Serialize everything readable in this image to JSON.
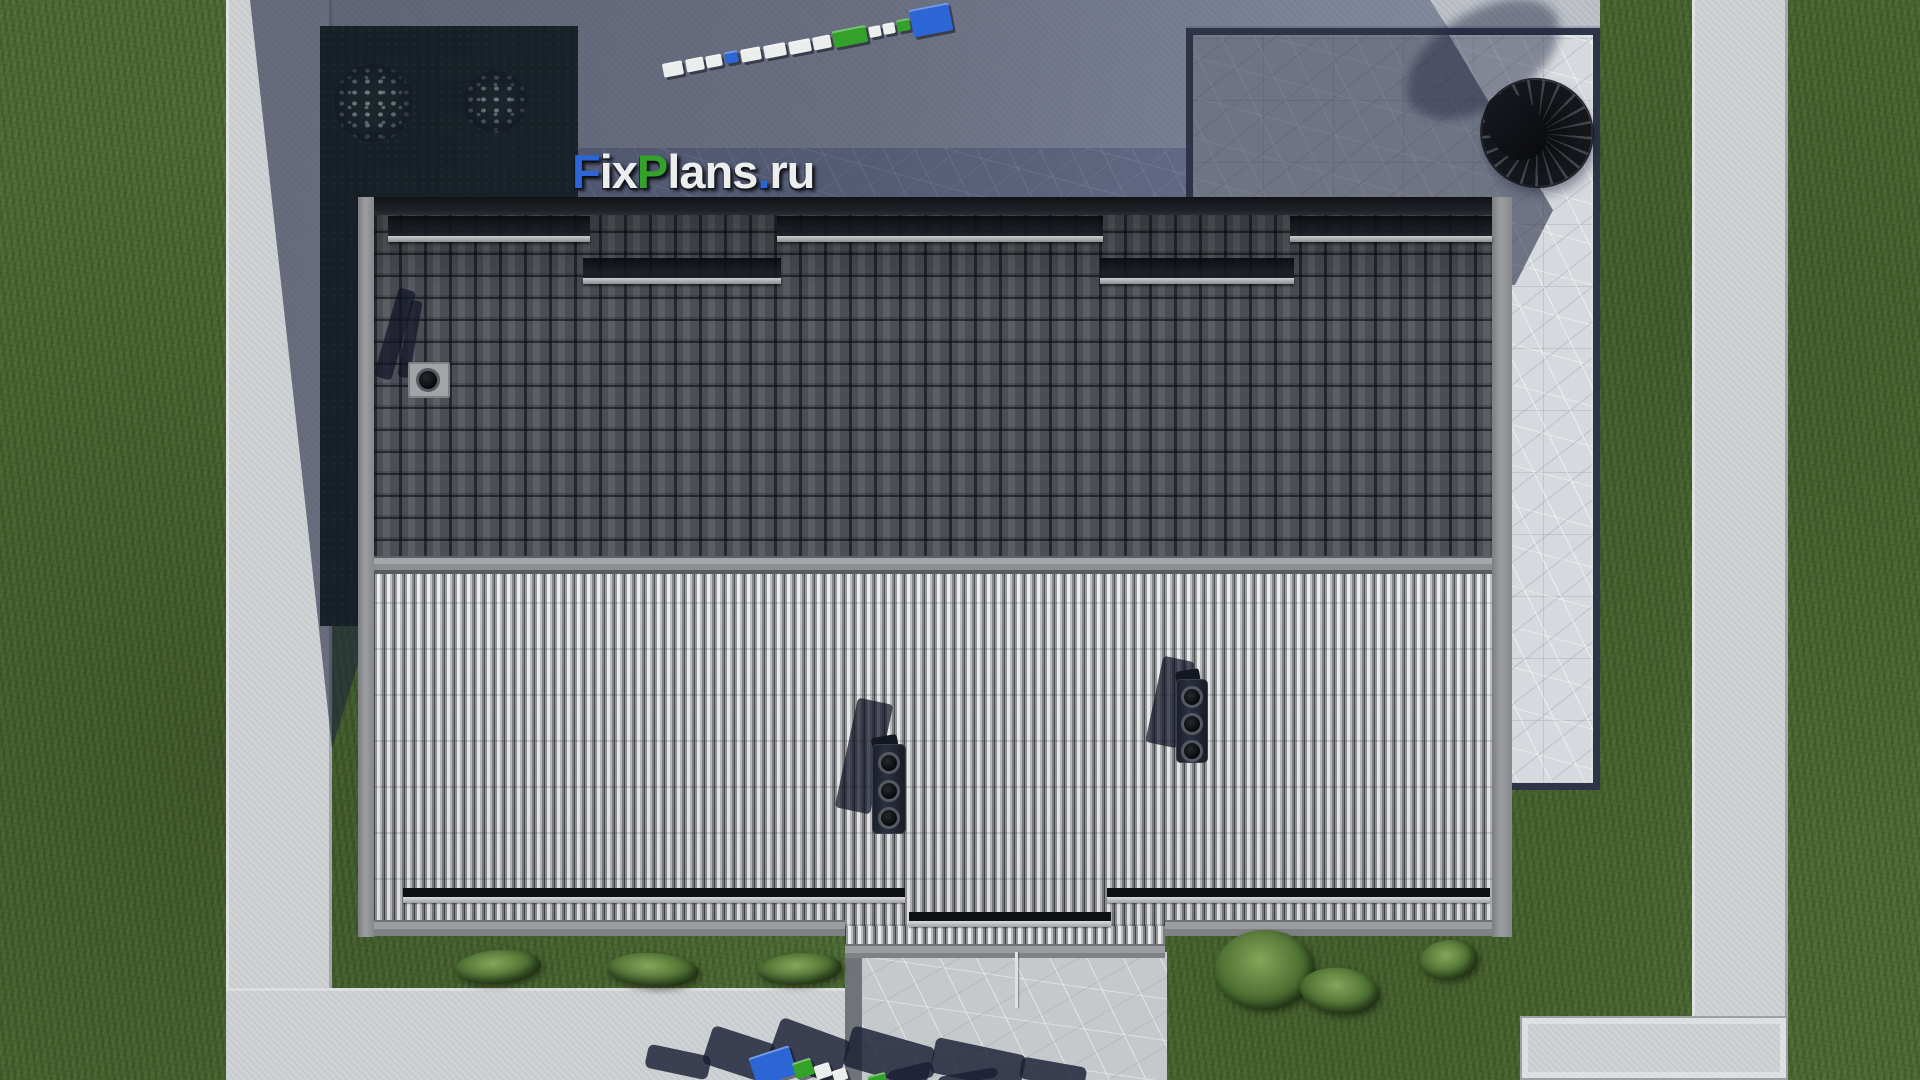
{
  "watermark": {
    "part_f": "F",
    "part_ix": "ix",
    "part_p": "P",
    "part_lans": "lans",
    "part_dot": ".",
    "part_ru": "ru"
  },
  "palette": {
    "grass": "#4c6a33",
    "bed": "#141f0c",
    "concrete": "#bdc1c8",
    "concreteSun": "#cfd2d5",
    "slab": "#d3d6d9",
    "stoneSun": "#d6d9dd",
    "stoneShade": "#8f96aa",
    "porch": "#c6c9cc",
    "fascia": "#8b8d90",
    "ridge": "#97999c",
    "darkRoof": "#4b4e55",
    "lightRoof": "#b9bbbe",
    "blue": "#2b66d4",
    "green": "#33a12a",
    "white": "#eceded",
    "navy": "rgba(26,31,53,0.82)",
    "shadow": "rgba(30,36,62,0.45)",
    "umbrella": "#14161b"
  },
  "scene": {
    "items": [
      {
        "n": "snowguard-band",
        "c": "sgband",
        "x": 388,
        "y": 216,
        "w": 202,
        "h": 20
      },
      {
        "n": "snowguard-bar",
        "c": "sgbar",
        "x": 388,
        "y": 236,
        "w": 202,
        "h": 6
      },
      {
        "n": "snowguard-band",
        "c": "sgband",
        "x": 777,
        "y": 216,
        "w": 326,
        "h": 20
      },
      {
        "n": "snowguard-bar",
        "c": "sgbar",
        "x": 777,
        "y": 236,
        "w": 326,
        "h": 6
      },
      {
        "n": "snowguard-band",
        "c": "sgband",
        "x": 1290,
        "y": 216,
        "w": 202,
        "h": 20
      },
      {
        "n": "snowguard-bar",
        "c": "sgbar",
        "x": 1290,
        "y": 236,
        "w": 202,
        "h": 6
      },
      {
        "n": "snowguard-band",
        "c": "sgband",
        "x": 583,
        "y": 258,
        "w": 198,
        "h": 20
      },
      {
        "n": "snowguard-bar",
        "c": "sgbar",
        "x": 583,
        "y": 278,
        "w": 198,
        "h": 6
      },
      {
        "n": "snowguard-band",
        "c": "sgband",
        "x": 1100,
        "y": 258,
        "w": 194,
        "h": 20
      },
      {
        "n": "snowguard-bar",
        "c": "sgbar",
        "x": 1100,
        "y": 278,
        "w": 194,
        "h": 6
      },
      {
        "n": "snowguard-band",
        "c": "sg2band",
        "x": 403,
        "y": 888,
        "w": 502,
        "h": 9
      },
      {
        "n": "snowguard-bar",
        "c": "sg2bar",
        "x": 403,
        "y": 897,
        "w": 502,
        "h": 6
      },
      {
        "n": "snowguard-band",
        "c": "sg2band",
        "x": 1107,
        "y": 888,
        "w": 383,
        "h": 9
      },
      {
        "n": "snowguard-bar",
        "c": "sg2bar",
        "x": 1107,
        "y": 897,
        "w": 383,
        "h": 6
      },
      {
        "n": "snowguard-band",
        "c": "sg2band",
        "x": 909,
        "y": 912,
        "w": 202,
        "h": 9
      },
      {
        "n": "snowguard-bar",
        "c": "sg2bar",
        "x": 909,
        "y": 921,
        "w": 202,
        "h": 6
      },
      {
        "n": "shrub",
        "c": "bush",
        "x": 455,
        "y": 950,
        "w": 86,
        "h": 34,
        "r": -4
      },
      {
        "n": "shrub",
        "c": "bush",
        "x": 607,
        "y": 953,
        "w": 92,
        "h": 34,
        "r": 3
      },
      {
        "n": "shrub",
        "c": "bush",
        "x": 758,
        "y": 953,
        "w": 84,
        "h": 32,
        "r": -3
      },
      {
        "n": "shrub",
        "c": "bush",
        "x": 1215,
        "y": 930,
        "w": 100,
        "h": 80,
        "r": 0
      },
      {
        "n": "shrub",
        "c": "bush",
        "x": 1300,
        "y": 968,
        "w": 80,
        "h": 46,
        "r": 6
      },
      {
        "n": "shrub",
        "c": "bush",
        "x": 1420,
        "y": 940,
        "w": 58,
        "h": 40,
        "r": -5
      },
      {
        "n": "flowering-bush",
        "c": "fbush",
        "x": 334,
        "y": 64,
        "w": 78,
        "h": 78
      },
      {
        "n": "flowering-bush",
        "c": "fbush",
        "x": 463,
        "y": 71,
        "w": 64,
        "h": 62
      },
      {
        "n": "chimney-shadow",
        "c": "cshadow",
        "x": 386,
        "y": 288,
        "w": 18,
        "h": 92,
        "r": 16
      },
      {
        "n": "chimney-shadow",
        "c": "cshadow",
        "x": 404,
        "y": 300,
        "w": 12,
        "h": 78,
        "r": 10
      },
      {
        "n": "chimney-base",
        "c": "cbase",
        "x": 408,
        "y": 362,
        "w": 42,
        "h": 36
      },
      {
        "n": "chimney-vent",
        "c": "vent",
        "x": 416,
        "y": 368,
        "w": 24,
        "h": 24
      },
      {
        "n": "chimney-shadow",
        "c": "cshadow",
        "x": 846,
        "y": 700,
        "w": 36,
        "h": 112,
        "r": 12
      },
      {
        "n": "chimney-cap",
        "c": "ccap",
        "x": 872,
        "y": 736,
        "w": 26,
        "h": 16,
        "r": -10
      },
      {
        "n": "chimney-housing",
        "c": "chousing",
        "x": 872,
        "y": 744,
        "w": 34,
        "h": 90
      },
      {
        "n": "chimney-vent",
        "c": "vent",
        "x": 878,
        "y": 752,
        "w": 22,
        "h": 22
      },
      {
        "n": "chimney-vent",
        "c": "vent",
        "x": 878,
        "y": 780,
        "w": 22,
        "h": 22
      },
      {
        "n": "chimney-vent",
        "c": "vent",
        "x": 878,
        "y": 807,
        "w": 22,
        "h": 22
      },
      {
        "n": "chimney-shadow",
        "c": "cshadow",
        "x": 1154,
        "y": 658,
        "w": 32,
        "h": 88,
        "r": 12
      },
      {
        "n": "chimney-cap",
        "c": "ccap",
        "x": 1176,
        "y": 670,
        "w": 24,
        "h": 15,
        "r": -10
      },
      {
        "n": "chimney-housing",
        "c": "chousing",
        "x": 1176,
        "y": 679,
        "w": 32,
        "h": 84
      },
      {
        "n": "chimney-vent",
        "c": "vent",
        "x": 1181,
        "y": 686,
        "w": 22,
        "h": 22
      },
      {
        "n": "chimney-vent",
        "c": "vent",
        "x": 1181,
        "y": 713,
        "w": 22,
        "h": 22
      },
      {
        "n": "chimney-vent",
        "c": "vent",
        "x": 1181,
        "y": 740,
        "w": 22,
        "h": 22
      },
      {
        "n": "downspout",
        "c": "pipe",
        "x": 1015,
        "y": 952,
        "w": 3,
        "h": 56
      },
      {
        "n": "logo-3d-block",
        "c": "blk",
        "x": 663,
        "y": 62,
        "w": 20,
        "h": 14,
        "r": -11,
        "col": "white"
      },
      {
        "n": "logo-3d-block",
        "c": "blk",
        "x": 686,
        "y": 58,
        "w": 18,
        "h": 13,
        "r": -11,
        "col": "white"
      },
      {
        "n": "logo-3d-block",
        "c": "blk",
        "x": 706,
        "y": 55,
        "w": 16,
        "h": 12,
        "r": -11,
        "col": "white"
      },
      {
        "n": "logo-3d-block",
        "c": "blk",
        "x": 725,
        "y": 51,
        "w": 13,
        "h": 12,
        "r": -11,
        "col": "blue"
      },
      {
        "n": "logo-3d-block",
        "c": "blk",
        "x": 741,
        "y": 48,
        "w": 20,
        "h": 13,
        "r": -11,
        "col": "white"
      },
      {
        "n": "logo-3d-block",
        "c": "blk",
        "x": 764,
        "y": 44,
        "w": 22,
        "h": 13,
        "r": -11,
        "col": "white"
      },
      {
        "n": "logo-3d-block",
        "c": "blk",
        "x": 789,
        "y": 40,
        "w": 22,
        "h": 13,
        "r": -11,
        "col": "white"
      },
      {
        "n": "logo-3d-block",
        "c": "blk",
        "x": 813,
        "y": 36,
        "w": 18,
        "h": 13,
        "r": -11,
        "col": "white"
      },
      {
        "n": "logo-3d-block",
        "c": "blk",
        "x": 833,
        "y": 28,
        "w": 34,
        "h": 17,
        "r": -11,
        "col": "green"
      },
      {
        "n": "logo-3d-block",
        "c": "blk",
        "x": 869,
        "y": 26,
        "w": 12,
        "h": 11,
        "r": -11,
        "col": "white"
      },
      {
        "n": "logo-3d-block",
        "c": "blk",
        "x": 883,
        "y": 23,
        "w": 12,
        "h": 11,
        "r": -11,
        "col": "white"
      },
      {
        "n": "logo-3d-block",
        "c": "blk",
        "x": 897,
        "y": 19,
        "w": 13,
        "h": 12,
        "r": -11,
        "col": "green"
      },
      {
        "n": "logo-3d-block",
        "c": "blk",
        "x": 911,
        "y": 6,
        "w": 40,
        "h": 28,
        "r": -11,
        "col": "blue"
      },
      {
        "n": "logo-shadow-blob",
        "c": "sblob",
        "x": 646,
        "y": 1050,
        "w": 64,
        "h": 24,
        "r": 12,
        "col": "navy"
      },
      {
        "n": "logo-shadow-blob",
        "c": "sblob",
        "x": 706,
        "y": 1034,
        "w": 66,
        "h": 40,
        "r": 18,
        "col": "navy"
      },
      {
        "n": "logo-shadow-blob",
        "c": "sblob",
        "x": 772,
        "y": 1028,
        "w": 74,
        "h": 46,
        "r": 20,
        "col": "navy"
      },
      {
        "n": "logo-shadow-blob",
        "c": "sblob",
        "x": 846,
        "y": 1036,
        "w": 86,
        "h": 42,
        "r": 16,
        "col": "navy"
      },
      {
        "n": "logo-shadow-blob",
        "c": "sblob",
        "x": 932,
        "y": 1046,
        "w": 92,
        "h": 36,
        "r": 12,
        "col": "navy"
      },
      {
        "n": "logo-shadow-blob",
        "c": "sblob",
        "x": 1020,
        "y": 1062,
        "w": 66,
        "h": 22,
        "r": 10,
        "col": "navy"
      },
      {
        "n": "logo-3d-block",
        "c": "blk",
        "x": 752,
        "y": 1051,
        "w": 42,
        "h": 30,
        "r": -18,
        "col": "blue"
      },
      {
        "n": "logo-3d-block",
        "c": "blk",
        "x": 794,
        "y": 1060,
        "w": 19,
        "h": 17,
        "r": -18,
        "col": "green"
      },
      {
        "n": "logo-3d-block",
        "c": "blk",
        "x": 815,
        "y": 1064,
        "w": 16,
        "h": 14,
        "r": -18,
        "col": "white"
      },
      {
        "n": "logo-3d-block",
        "c": "blk",
        "x": 833,
        "y": 1069,
        "w": 14,
        "h": 12,
        "r": -18,
        "col": "white"
      },
      {
        "n": "logo-3d-block",
        "c": "blk",
        "x": 868,
        "y": 1074,
        "w": 18,
        "h": 8,
        "r": -15,
        "col": "green"
      },
      {
        "n": "logo-3d-block",
        "c": "sblob",
        "x": 888,
        "y": 1066,
        "w": 46,
        "h": 16,
        "r": -14,
        "col": "navy"
      },
      {
        "n": "logo-3d-block",
        "c": "sblob",
        "x": 938,
        "y": 1072,
        "w": 60,
        "h": 10,
        "r": -10,
        "col": "navy"
      },
      {
        "n": "umbrella-shadow",
        "c": "ushadow",
        "x": 1398,
        "y": 12,
        "w": 170,
        "h": 94,
        "r": -32,
        "col": "shadow"
      },
      {
        "n": "patio-umbrella",
        "c": "ucanopy",
        "x": 1482,
        "y": 80,
        "w": 110,
        "h": 106
      },
      {
        "n": "umbrella-folded-canopy",
        "c": "ufold",
        "x": 1488,
        "y": 90,
        "w": 54,
        "h": 72,
        "r": -28
      }
    ]
  }
}
